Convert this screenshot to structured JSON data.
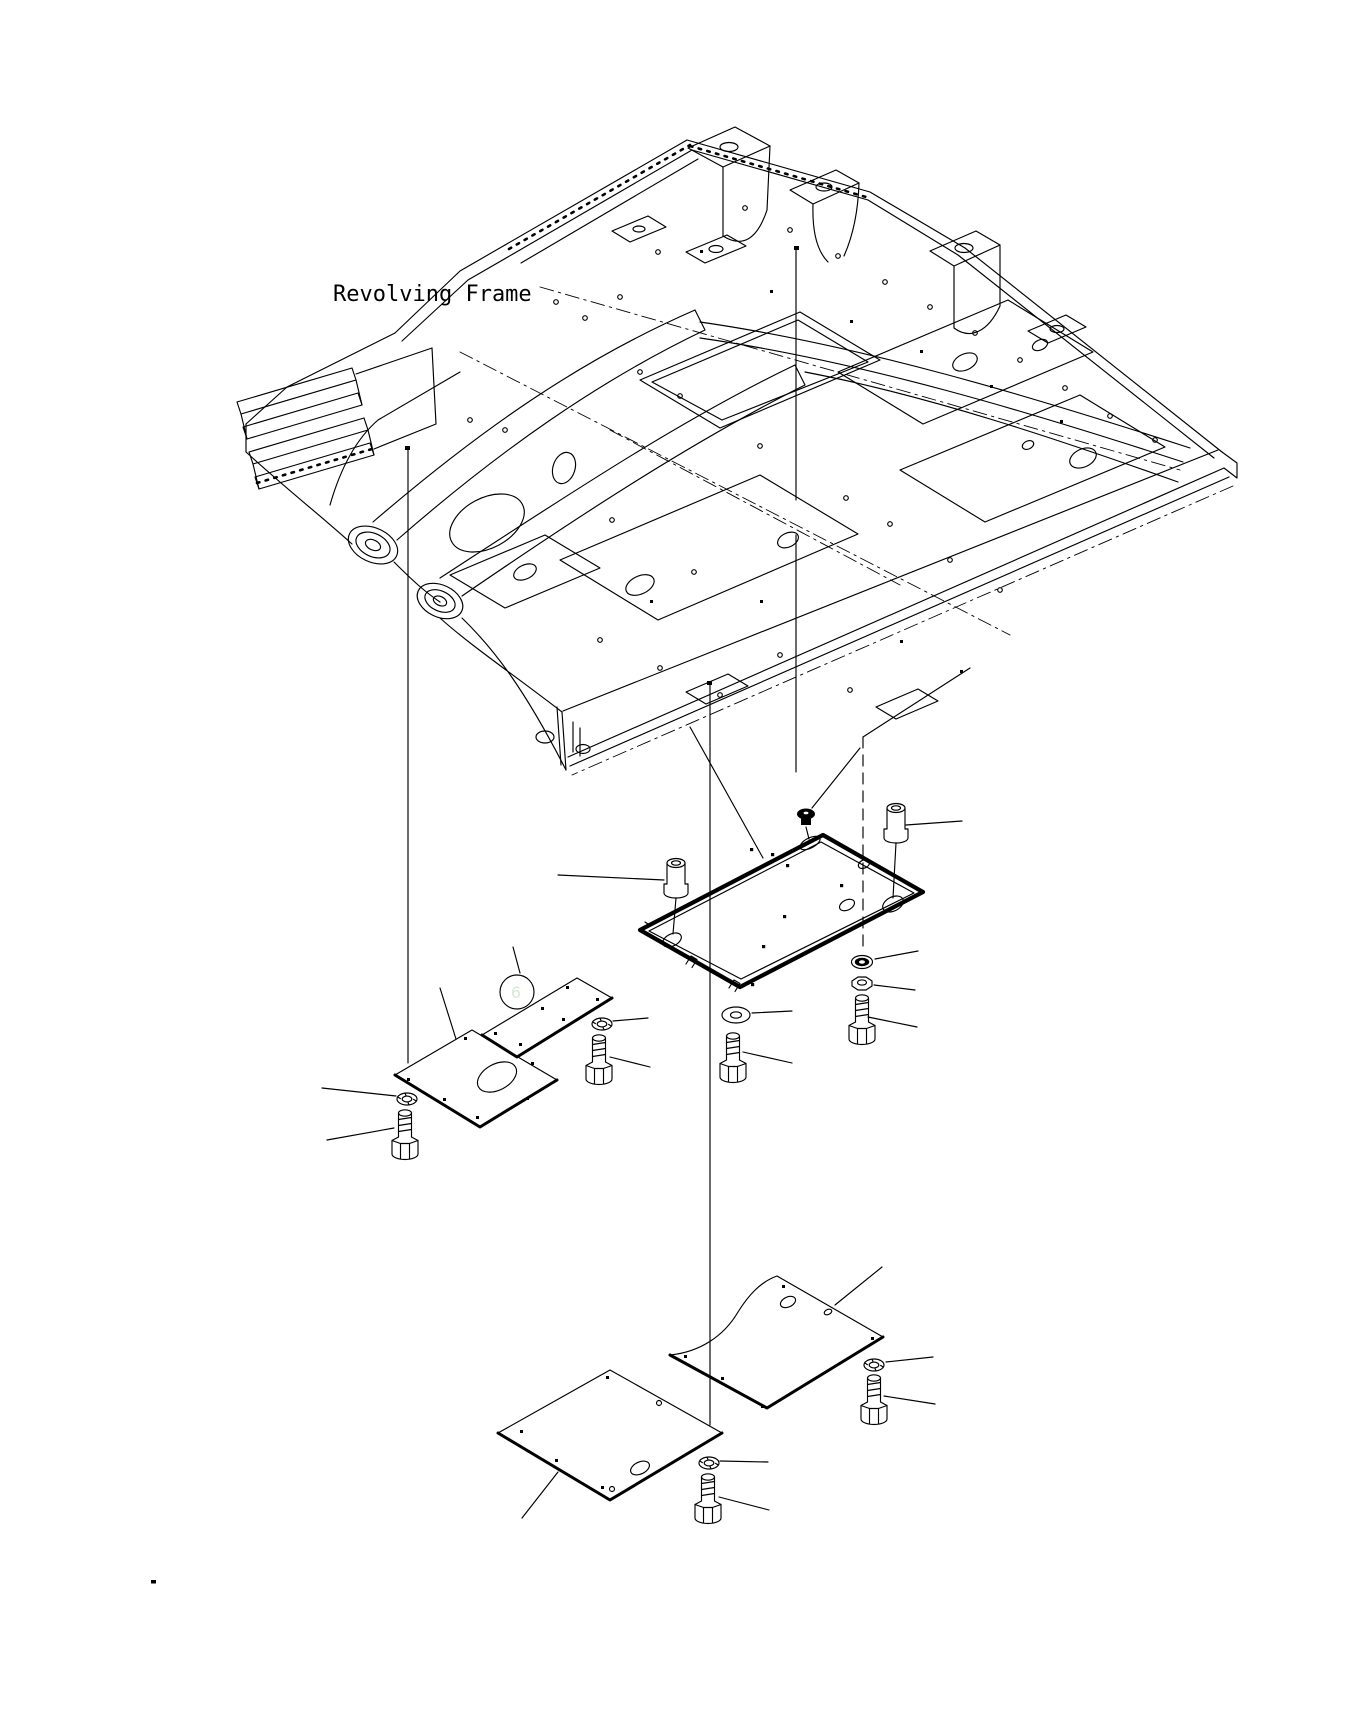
{
  "diagram": {
    "frame_label": "Revolving Frame",
    "callout": {
      "number": "6"
    }
  },
  "colors": {
    "background": "#ffffff",
    "line": "#000000",
    "callout_fill": "#1c7d1c",
    "callout_ring": "#000000",
    "callout_text": "#d9e7d9"
  }
}
